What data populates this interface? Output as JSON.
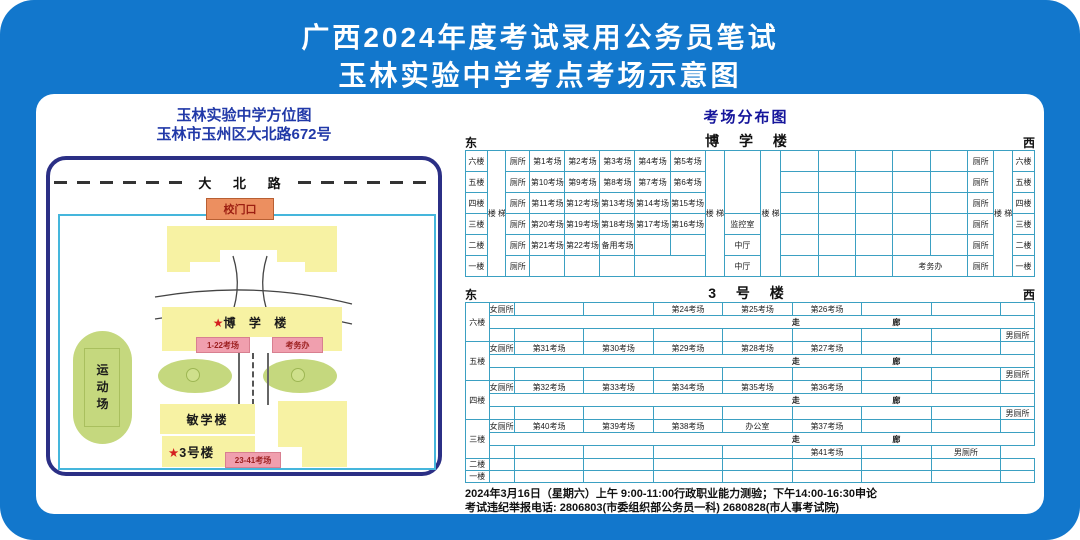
{
  "colors": {
    "background_blue": "#1277cc",
    "map_border_navy": "#2b2f85",
    "table_border_cyan": "#3ba0c2",
    "building_yellow": "#f7f2a3",
    "green_area": "#c5d87e",
    "gate_orange": "#ec8f60",
    "label_pink": "#f09fae",
    "star_red": "#d42020",
    "map_title_blue": "#2139a8",
    "dist_title_blue": "#15159b"
  },
  "header": {
    "line1": "广西2024年度考试录用公务员笔试",
    "line2": "玉林实验中学考点考场示意图"
  },
  "map": {
    "title": "玉林实验中学方位图",
    "address": "玉林市玉州区大北路672号",
    "road": "大 北 路",
    "gate": "校门口",
    "star": "★",
    "boxue_name": "博 学 楼",
    "rooms_1_22": "1-22考场",
    "exam_office": "考务办",
    "sports_field": "运\n动\n场",
    "minxue_name": "敏学楼",
    "bld3_name": "3号楼",
    "rooms_23_41": "23-41考场"
  },
  "dist": {
    "title": "考场分布图",
    "east": "东",
    "west": "西",
    "boxue_name": "博 学 楼",
    "bld3_name": "3 号 楼"
  },
  "footer": {
    "line1": "2024年3月16日（星期六）上午 9:00-11:00行政职业能力测验；下午14:00-16:30申论",
    "line2": "考试违纪举报电话: 2806803(市委组织部公务员一科)   2680828(市人事考试院)"
  },
  "tables": {
    "boxue": {
      "cols": [
        3.8,
        3.2,
        4.2,
        6.1,
        6.1,
        6.1,
        6.1,
        6.1,
        3.4,
        6.2,
        3.6,
        6.5,
        6.5,
        6.5,
        6.5,
        6.5,
        4.5,
        3.3,
        3.8
      ],
      "rows": [
        {
          "cells": [
            {
              "t": "六楼",
              "c": "fl"
            },
            {
              "t": "楼\n梯",
              "c": "v",
              "rs": 6
            },
            {
              "t": "厕所",
              "c": "wc"
            },
            {
              "t": "第1考场"
            },
            {
              "t": "第2考场"
            },
            {
              "t": "第3考场"
            },
            {
              "t": "第4考场"
            },
            {
              "t": "第5考场"
            },
            {
              "t": "楼\n梯",
              "c": "v",
              "rs": 6
            },
            {
              "t": "",
              "rs": 3
            },
            {
              "t": "楼\n梯",
              "c": "v",
              "rs": 6
            },
            {
              "t": ""
            },
            {
              "t": ""
            },
            {
              "t": ""
            },
            {
              "t": ""
            },
            {
              "t": ""
            },
            {
              "t": "厕所",
              "c": "wc"
            },
            {
              "t": "楼\n梯",
              "c": "v",
              "rs": 6
            },
            {
              "t": "六楼",
              "c": "fl"
            }
          ]
        },
        {
          "cells": [
            {
              "t": "五楼",
              "c": "fl"
            },
            {
              "t": "厕所",
              "c": "wc"
            },
            {
              "t": "第10考场"
            },
            {
              "t": "第9考场"
            },
            {
              "t": "第8考场"
            },
            {
              "t": "第7考场"
            },
            {
              "t": "第6考场"
            },
            {
              "t": ""
            },
            {
              "t": ""
            },
            {
              "t": ""
            },
            {
              "t": ""
            },
            {
              "t": ""
            },
            {
              "t": "厕所",
              "c": "wc"
            },
            {
              "t": "五楼",
              "c": "fl"
            }
          ]
        },
        {
          "cells": [
            {
              "t": "四楼",
              "c": "fl"
            },
            {
              "t": "厕所",
              "c": "wc"
            },
            {
              "t": "第11考场"
            },
            {
              "t": "第12考场"
            },
            {
              "t": "第13考场"
            },
            {
              "t": "第14考场"
            },
            {
              "t": "第15考场"
            },
            {
              "t": ""
            },
            {
              "t": ""
            },
            {
              "t": ""
            },
            {
              "t": ""
            },
            {
              "t": ""
            },
            {
              "t": "厕所",
              "c": "wc"
            },
            {
              "t": "四楼",
              "c": "fl"
            }
          ]
        },
        {
          "cells": [
            {
              "t": "三楼",
              "c": "fl"
            },
            {
              "t": "厕所",
              "c": "wc"
            },
            {
              "t": "第20考场"
            },
            {
              "t": "第19考场"
            },
            {
              "t": "第18考场"
            },
            {
              "t": "第17考场"
            },
            {
              "t": "第16考场"
            },
            {
              "t": "监控室"
            },
            {
              "t": ""
            },
            {
              "t": ""
            },
            {
              "t": ""
            },
            {
              "t": ""
            },
            {
              "t": ""
            },
            {
              "t": "厕所",
              "c": "wc"
            },
            {
              "t": "三楼",
              "c": "fl"
            }
          ]
        },
        {
          "cells": [
            {
              "t": "二楼",
              "c": "fl"
            },
            {
              "t": "厕所",
              "c": "wc"
            },
            {
              "t": "第21考场"
            },
            {
              "t": "第22考场"
            },
            {
              "t": "备用考场"
            },
            {
              "t": ""
            },
            {
              "t": ""
            },
            {
              "t": "中厅"
            },
            {
              "t": ""
            },
            {
              "t": ""
            },
            {
              "t": ""
            },
            {
              "t": ""
            },
            {
              "t": ""
            },
            {
              "t": "厕所",
              "c": "wc"
            },
            {
              "t": "二楼",
              "c": "fl"
            }
          ]
        },
        {
          "cells": [
            {
              "t": "一楼",
              "c": "fl"
            },
            {
              "t": "厕所",
              "c": "wc"
            },
            {
              "t": ""
            },
            {
              "t": ""
            },
            {
              "t": ""
            },
            {
              "t": "",
              "cs": 2
            },
            {
              "t": "中厅"
            },
            {
              "t": ""
            },
            {
              "t": ""
            },
            {
              "t": ""
            },
            {
              "t": "考务办",
              "cs": 2
            },
            {
              "t": "厕所",
              "c": "wc"
            },
            {
              "t": "一楼",
              "c": "fl"
            }
          ]
        }
      ]
    },
    "bld3": {
      "cols": [
        4.1,
        4.4,
        12.1,
        12.1,
        12.1,
        12.1,
        12.1,
        12.1,
        12.1,
        5.9
      ],
      "rows": [
        {
          "cells": [
            {
              "t": "六楼",
              "c": "fl",
              "rs": 3
            },
            {
              "t": "女厕所",
              "c": "wc"
            },
            {
              "t": ""
            },
            {
              "t": ""
            },
            {
              "t": "第24考场"
            },
            {
              "t": "第25考场"
            },
            {
              "t": "第26考场"
            },
            {
              "t": ""
            },
            {
              "t": ""
            },
            {
              "t": ""
            }
          ]
        },
        {
          "cells": [
            {
              "t": "走|廊",
              "c": "corr",
              "cs": 9
            }
          ]
        },
        {
          "cells": [
            {
              "t": ""
            },
            {
              "t": ""
            },
            {
              "t": ""
            },
            {
              "t": ""
            },
            {
              "t": ""
            },
            {
              "t": ""
            },
            {
              "t": ""
            },
            {
              "t": ""
            },
            {
              "t": "男厕所",
              "c": "wc"
            }
          ]
        },
        {
          "cells": [
            {
              "t": "五楼",
              "c": "fl",
              "rs": 3
            },
            {
              "t": "女厕所",
              "c": "wc"
            },
            {
              "t": "第31考场"
            },
            {
              "t": "第30考场"
            },
            {
              "t": "第29考场"
            },
            {
              "t": "第28考场"
            },
            {
              "t": "第27考场"
            },
            {
              "t": ""
            },
            {
              "t": ""
            },
            {
              "t": ""
            }
          ]
        },
        {
          "cells": [
            {
              "t": "走|廊",
              "c": "corr",
              "cs": 9
            }
          ]
        },
        {
          "cells": [
            {
              "t": ""
            },
            {
              "t": ""
            },
            {
              "t": ""
            },
            {
              "t": ""
            },
            {
              "t": ""
            },
            {
              "t": ""
            },
            {
              "t": ""
            },
            {
              "t": ""
            },
            {
              "t": "男厕所",
              "c": "wc"
            }
          ]
        },
        {
          "cells": [
            {
              "t": "四楼",
              "c": "fl",
              "rs": 3
            },
            {
              "t": "女厕所",
              "c": "wc"
            },
            {
              "t": "第32考场"
            },
            {
              "t": "第33考场"
            },
            {
              "t": "第34考场"
            },
            {
              "t": "第35考场"
            },
            {
              "t": "第36考场"
            },
            {
              "t": ""
            },
            {
              "t": ""
            },
            {
              "t": ""
            }
          ]
        },
        {
          "cells": [
            {
              "t": "走|廊",
              "c": "corr",
              "cs": 9
            }
          ]
        },
        {
          "cells": [
            {
              "t": ""
            },
            {
              "t": ""
            },
            {
              "t": ""
            },
            {
              "t": ""
            },
            {
              "t": ""
            },
            {
              "t": ""
            },
            {
              "t": ""
            },
            {
              "t": ""
            },
            {
              "t": "男厕所",
              "c": "wc"
            }
          ]
        },
        {
          "cells": [
            {
              "t": "三楼",
              "c": "fl",
              "rs": 3
            },
            {
              "t": "女厕所",
              "c": "wc"
            },
            {
              "t": "第40考场"
            },
            {
              "t": "第39考场"
            },
            {
              "t": "第38考场"
            },
            {
              "t": "办公室"
            },
            {
              "t": "第37考场"
            },
            {
              "t": ""
            },
            {
              "t": ""
            },
            {
              "t": ""
            }
          ]
        },
        {
          "cells": [
            {
              "t": "走|廊",
              "c": "corr",
              "cs": 9
            }
          ]
        },
        {
          "cells": [
            {
              "t": ""
            },
            {
              "t": ""
            },
            {
              "t": ""
            },
            {
              "t": ""
            },
            {
              "t": ""
            },
            {
              "t": "第41考场"
            },
            {
              "t": ""
            },
            {
              "t": "男厕所",
              "c": "wc"
            }
          ]
        },
        {
          "c": "hB",
          "cells": [
            {
              "t": "二楼",
              "c": "fl"
            },
            {
              "t": ""
            },
            {
              "t": ""
            },
            {
              "t": ""
            },
            {
              "t": ""
            },
            {
              "t": ""
            },
            {
              "t": ""
            },
            {
              "t": ""
            },
            {
              "t": ""
            },
            {
              "t": ""
            }
          ]
        },
        {
          "c": "hB",
          "cells": [
            {
              "t": "一楼",
              "c": "fl"
            },
            {
              "t": ""
            },
            {
              "t": ""
            },
            {
              "t": ""
            },
            {
              "t": ""
            },
            {
              "t": ""
            },
            {
              "t": ""
            },
            {
              "t": ""
            },
            {
              "t": ""
            },
            {
              "t": ""
            }
          ]
        }
      ]
    }
  }
}
